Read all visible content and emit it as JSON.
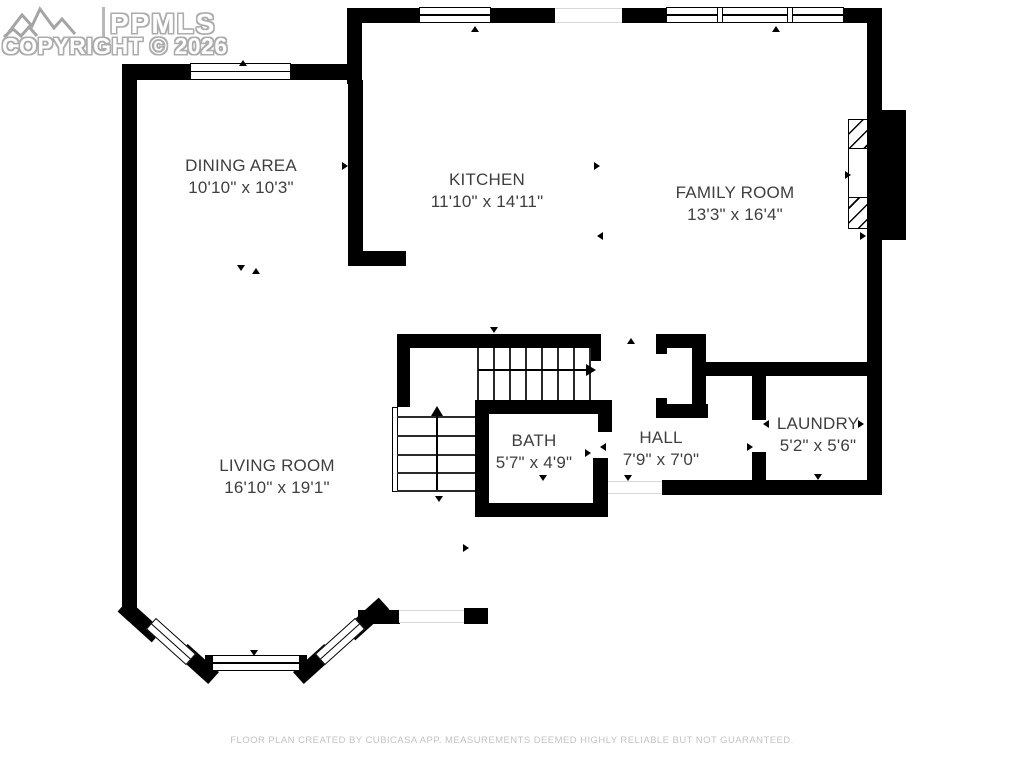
{
  "watermark": {
    "logo_icon": "mountains-icon",
    "brand": "PPMLS",
    "copyright": "COPYRIGHT © 2026"
  },
  "rooms": [
    {
      "name": "DINING AREA",
      "dims": "10'10\" x 10'3\""
    },
    {
      "name": "KITCHEN",
      "dims": "11'10\" x 14'11\""
    },
    {
      "name": "FAMILY ROOM",
      "dims": "13'3\" x 16'4\""
    },
    {
      "name": "LIVING ROOM",
      "dims": "16'10\" x 19'1\""
    },
    {
      "name": "BATH",
      "dims": "5'7\" x 4'9\""
    },
    {
      "name": "HALL",
      "dims": "7'9\" x 7'0\""
    },
    {
      "name": "LAUNDRY",
      "dims": "5'2\" x 5'6\""
    }
  ],
  "features": {
    "fireplace": "fireplace-hatched",
    "staircase": "l-shaped-staircase",
    "bay_window": "living-room-bay-window"
  },
  "footer": {
    "disclaimer": "FLOOR PLAN CREATED BY CUBICASA APP. MEASUREMENTS DEEMED HIGHLY RELIABLE BUT NOT GUARANTEED."
  },
  "colors": {
    "wall": "#000000",
    "label_text": "#3f3f3f",
    "watermark_outline": "#acacac",
    "footer_text": "#c3c3c3"
  }
}
